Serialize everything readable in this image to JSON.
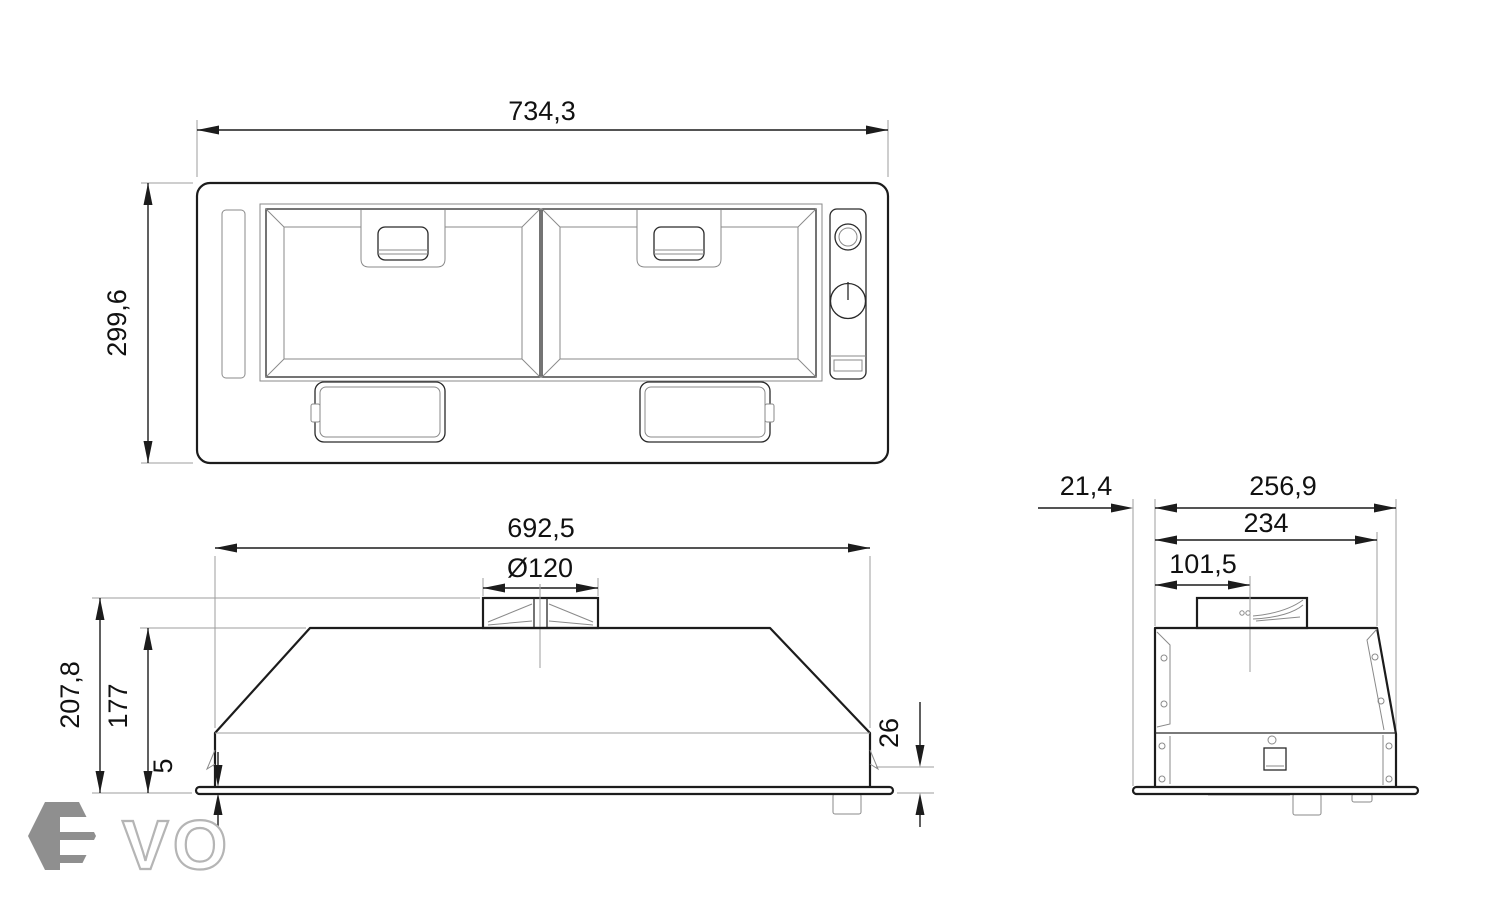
{
  "drawing": {
    "subject": "built-in cooker hood dimension drawing",
    "views": [
      "top view",
      "front view",
      "side view"
    ]
  },
  "top_view": {
    "width": "734,3",
    "depth": "299,6"
  },
  "front_view": {
    "width": "692,5",
    "duct_diameter": "Ø120",
    "height_total": "207,8",
    "height_body": "177",
    "flange_thickness": "5",
    "recess_height": "26"
  },
  "side_view": {
    "flange_overhang": "21,4",
    "depth_total": "256,9",
    "depth_top": "234",
    "duct_center_offset": "101,5"
  },
  "logo": {
    "text": "VO"
  },
  "colors": {
    "line": "#1c1c1c",
    "extension": "#9e9e9e",
    "detail": "#8a8a8a",
    "logo_gray": "#8f8f8f",
    "logo_outline": "#b5b5b5"
  }
}
